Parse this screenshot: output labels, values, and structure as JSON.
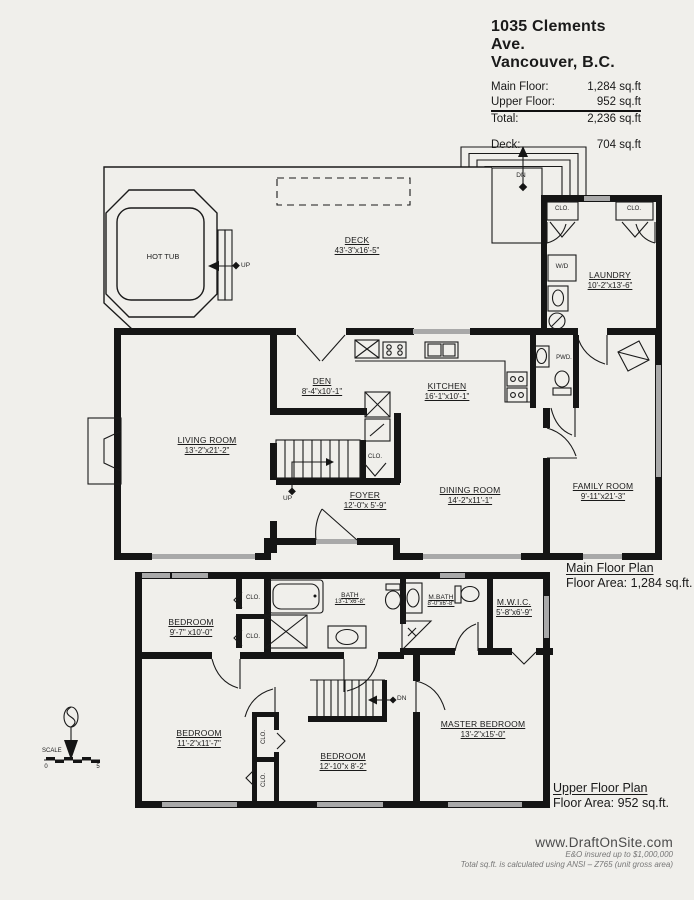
{
  "header": {
    "address_line1": "1035 Clements Ave.",
    "address_line2": "Vancouver, B.C.",
    "rows": [
      {
        "label": "Main Floor:",
        "value": "1,284 sq.ft"
      },
      {
        "label": "Upper Floor:",
        "value": "952 sq.ft"
      },
      {
        "label": "Total:",
        "value": "2,236 sq.ft"
      },
      {
        "label": "Deck:",
        "value": "704 sq.ft"
      }
    ]
  },
  "annotations": {
    "up": "UP",
    "dn": "DN",
    "clo": "CLO.",
    "wd": "W/D",
    "pwd": "PWD.",
    "hot_tub": "HOT TUB",
    "scale": "SCALE",
    "scale_start": "0",
    "scale_end": "5"
  },
  "main_floor": {
    "caption_title": "Main Floor Plan",
    "caption_area": "Floor Area: 1,284 sq.ft.",
    "rooms": {
      "deck": {
        "name": "DECK",
        "dims": "43'-3\"x16'-5\""
      },
      "laundry": {
        "name": "LAUNDRY",
        "dims": "10'-2\"x13'-6\""
      },
      "den": {
        "name": "DEN",
        "dims": "8'-4\"x10'-1\""
      },
      "kitchen": {
        "name": "KITCHEN",
        "dims": "16'-1\"x10'-1\""
      },
      "living_room": {
        "name": "LIVING ROOM",
        "dims": "13'-2\"x21'-2\""
      },
      "foyer": {
        "name": "FOYER",
        "dims": "12'-0\"x 5'-9\""
      },
      "dining_room": {
        "name": "DINING ROOM",
        "dims": "14'-2\"x11'-1\""
      },
      "family_room": {
        "name": "FAMILY ROOM",
        "dims": "9'-11\"x21'-3\""
      }
    }
  },
  "upper_floor": {
    "caption_title": "Upper Floor Plan",
    "caption_area": "Floor Area: 952 sq.ft.",
    "rooms": {
      "bedroom_nw": {
        "name": "BEDROOM",
        "dims": "9'-7\" x10'-0\""
      },
      "bath": {
        "name": "BATH",
        "dims": "13'-1\"x6'-8\""
      },
      "master_bath": {
        "name": "M.BATH",
        "dims": "8'-0\"x6'-8\""
      },
      "walk_in_closet": {
        "name": "M.W.I.C.",
        "dims": "5'-8\"x6'-9\""
      },
      "bedroom_sw": {
        "name": "BEDROOM",
        "dims": "11'-2\"x11'-7\""
      },
      "bedroom_s": {
        "name": "BEDROOM",
        "dims": "12'-10\"x 8'-2\""
      },
      "master_bedroom": {
        "name": "MASTER BEDROOM",
        "dims": "13'-2\"x15'-0\""
      }
    }
  },
  "footer": {
    "website": "www.DraftOnSite.com",
    "insurance": "E&O insured up to $1,000,000",
    "disclaimer": "Total sq.ft. is calculated using ANSI – Z765 (unit gross area)"
  }
}
